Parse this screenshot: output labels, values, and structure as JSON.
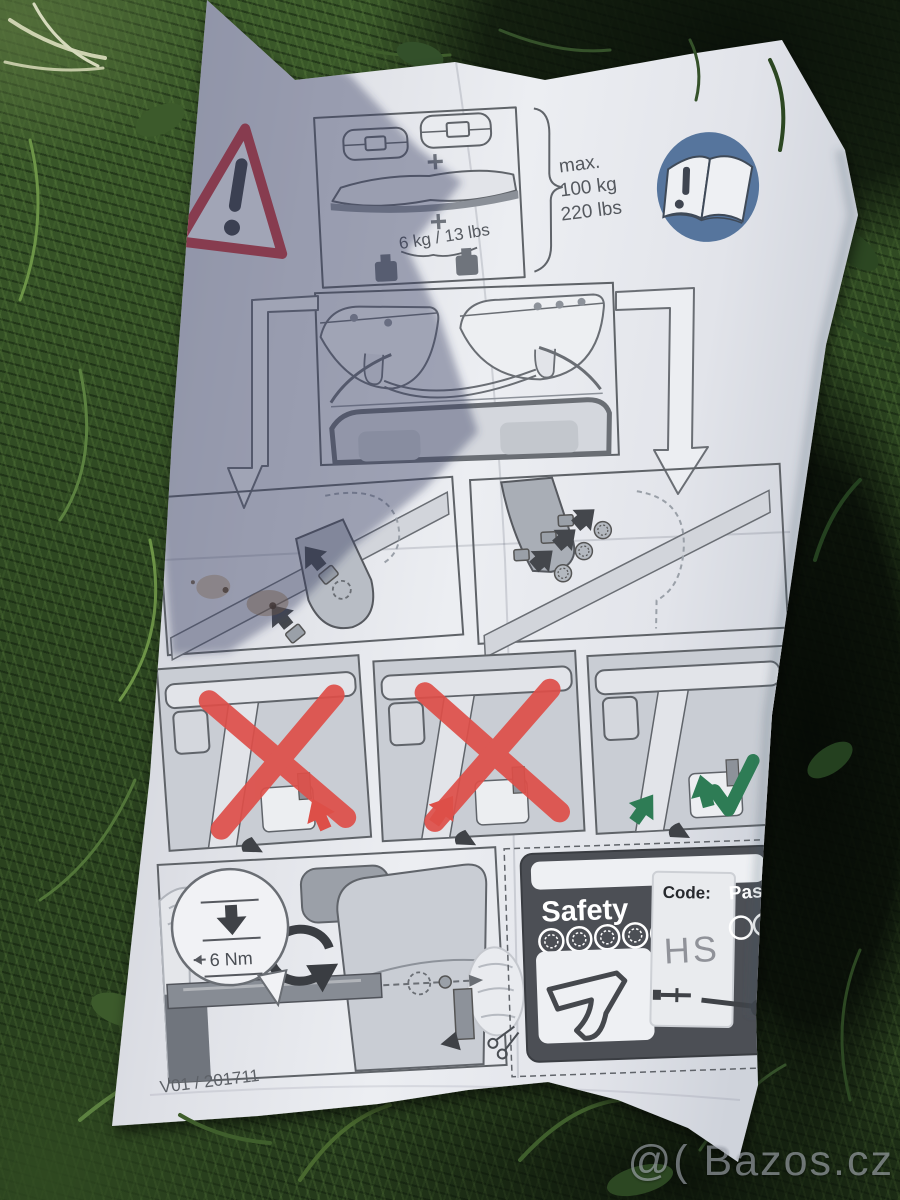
{
  "leaflet": {
    "load_panel": {
      "plus": "+",
      "box_weight": "6 kg / 13 lbs",
      "max_label": "max.",
      "max_kg": "100 kg",
      "max_lbs": "220 lbs"
    },
    "torque_panel": {
      "torque": "6 Nm"
    },
    "safety_card": {
      "title": "Safety",
      "code_label": "Code:",
      "code_value": "HS",
      "pass_label": "Pass"
    },
    "footer": {
      "version": "V01 / 201711"
    }
  },
  "watermark": {
    "text": "@( Bazos.cz"
  },
  "icons": {
    "warning": "warning-triangle-exclamation",
    "read_manual": "open-book-exclamation",
    "scissors": "cut-here-scissors",
    "red_cross": "red-x-prohibited",
    "green_check": "check-mark-correct"
  },
  "colors": {
    "warning_red": "#c23c41",
    "cross_red": "#de4f49",
    "manual_blue": "#56759d",
    "check_green": "#2e7c55",
    "card_gray": "#4c4f55",
    "paper": "#e9ebef",
    "grass_dark": "#24371b"
  }
}
